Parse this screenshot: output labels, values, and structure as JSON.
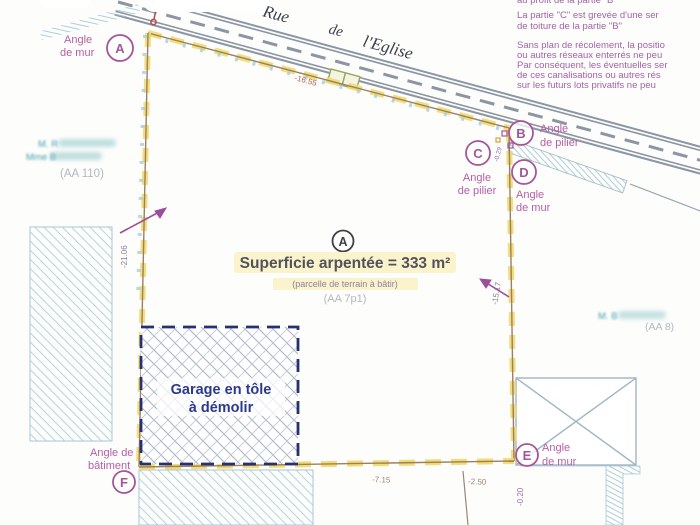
{
  "street": {
    "word1": "Rue",
    "word2": "de",
    "word3": "l'Eglise"
  },
  "notes": {
    "clipped_line": "au profit de la partie \"B\"",
    "lines": [
      "La partie \"C\" est grevée d'une ser",
      "de toiture de la partie \"B\"",
      "Sans plan de récolement, la positio",
      "ou autres réseaux enterrés ne peu",
      "Par conséquent, les éventuelles ser",
      "de ces canalisations ou autres rés",
      "sur les futurs lots privatifs ne peu"
    ]
  },
  "parcel": {
    "letter": "A",
    "area_label": "Superficie arpentée = 333 m²",
    "subtitle": "(parcelle de terrain à bâtir)",
    "ref": "(AA 7p1)"
  },
  "garage": {
    "line1": "Garage en tôle",
    "line2": "à démolir"
  },
  "points": [
    {
      "letter": "A",
      "line1": "Angle",
      "line2": "de mur"
    },
    {
      "letter": "B",
      "line1": "Angle",
      "line2": "de pilier"
    },
    {
      "letter": "C",
      "line1": "Angle",
      "line2": "de pilier"
    },
    {
      "letter": "D",
      "line1": "Angle",
      "line2": "de mur"
    },
    {
      "letter": "E",
      "line1": "Angle",
      "line2": "de mur"
    },
    {
      "letter": "F",
      "line1": "Angle de",
      "line2": "bâtiment"
    }
  ],
  "measurements": {
    "top": "-16.55",
    "left": "-21.06",
    "right": "-15.17",
    "bottom1": "-7.15",
    "bottom2": "-2.50",
    "e_offset": "-0.20",
    "c_offset": "-0.29"
  },
  "neighbors": {
    "left_name1": "M. R",
    "left_name2": "Mme B",
    "left_ref": "(AA 110)",
    "right_name": "M. B",
    "right_ref": "(AA 8)"
  },
  "colors": {
    "note_purple": "#a263a8",
    "label_pink": "#b55fa5",
    "circle_purple": "#a4569b",
    "boundary_yellow": "#f1da6e",
    "boundary_brown": "#9c7f63",
    "road_gray": "#8b95a3",
    "hatch_blue": "#aecfdb",
    "garage_navy": "#28316f",
    "measure_red": "#bf5a52",
    "ref_gray": "#b2b8c2",
    "blur_teal": "#3f9fae"
  }
}
